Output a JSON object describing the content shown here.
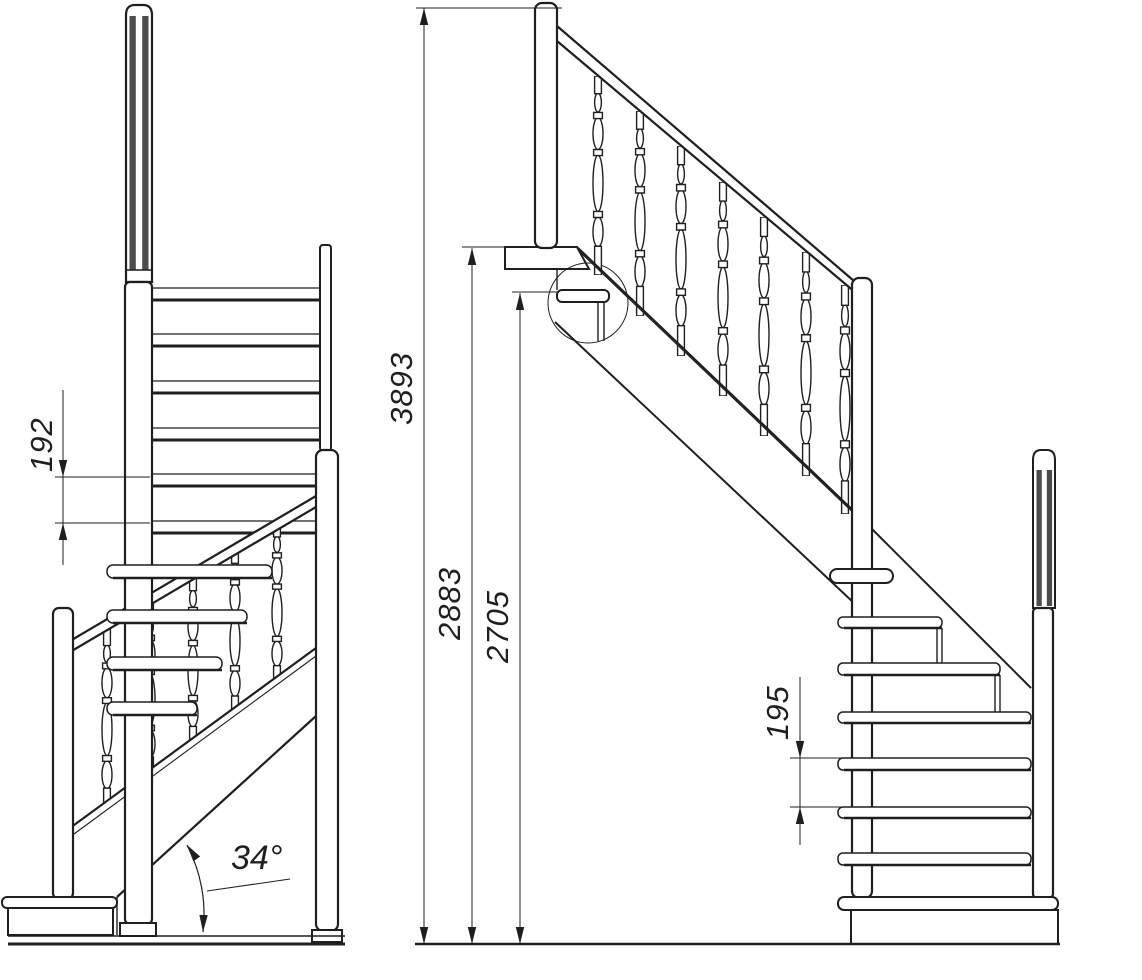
{
  "drawing": {
    "kind": "staircase technical drawing, two orthographic views",
    "front_view": {
      "riser_dimension": "192",
      "angle_label": "34°"
    },
    "side_view": {
      "total_height": "3893",
      "floor_level_height": "2883",
      "first_tread_height": "2705",
      "riser_dimension": "195"
    }
  },
  "colors": {
    "line": "#1f1f1f",
    "handrail_end_fill": "#4c4c4c",
    "background": "#ffffff"
  }
}
